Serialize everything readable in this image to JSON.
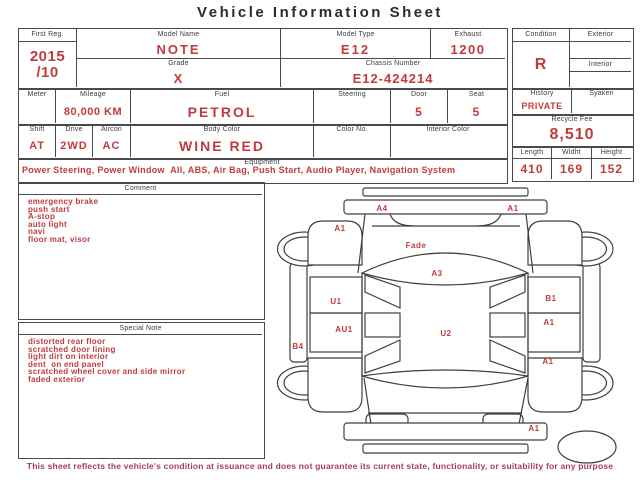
{
  "title": "Vehicle Information Sheet",
  "colors": {
    "accent_red": "#c23b3c",
    "border_gray": "#4a4a4a",
    "label_gray": "#3b3b3b",
    "footer_red": "#a83d52"
  },
  "fields": {
    "first_reg": {
      "label": "First Reg.",
      "value": "2015\n/10"
    },
    "model_name": {
      "label": "Model Name",
      "value": "NOTE"
    },
    "model_type": {
      "label": "Model Type",
      "value": "E12"
    },
    "exhaust": {
      "label": "Exhaust",
      "value": "1200"
    },
    "grade": {
      "label": "Grade",
      "value": "X"
    },
    "chassis_number": {
      "label": "Chassis Number",
      "value": "E12-424214"
    },
    "condition": {
      "label": "Condition",
      "value": "R"
    },
    "exterior": {
      "label": "Exterior",
      "value": ""
    },
    "interior": {
      "label": "Interior",
      "value": ""
    },
    "meter": {
      "label": "Meter",
      "value": ""
    },
    "mileage": {
      "label": "Mileage",
      "value": "80,000 KM"
    },
    "fuel": {
      "label": "Fuel",
      "value": "PETROL"
    },
    "steering": {
      "label": "Steering",
      "value": ""
    },
    "door": {
      "label": "Door",
      "value": "5"
    },
    "seat": {
      "label": "Seat",
      "value": "5"
    },
    "history": {
      "label": "History",
      "value": "PRIVATE"
    },
    "syaken": {
      "label": "Syaken",
      "value": ""
    },
    "shift": {
      "label": "Shift",
      "value": "AT"
    },
    "drive": {
      "label": "Drive",
      "value": "2WD"
    },
    "aircon": {
      "label": "Aircon",
      "value": "AC"
    },
    "body_color": {
      "label": "Body Color",
      "value": "WINE RED"
    },
    "color_no": {
      "label": "Color No.",
      "value": ""
    },
    "interior_color": {
      "label": "Interior Color",
      "value": ""
    },
    "recycle_fee": {
      "label": "Recycle Fee",
      "value": "8,510"
    },
    "equipment": {
      "label": "Equipment",
      "value": "Power Steering, Power Window  All, ABS, Air Bag, Push Start, Audio Player, Navigation System"
    },
    "length": {
      "label": "Length",
      "value": "410"
    },
    "width": {
      "label": "Widht",
      "value": "169"
    },
    "height": {
      "label": "Height",
      "value": "152"
    }
  },
  "comment": {
    "label": "Comment",
    "text": "emergency brake\npush start\nA-stop\nauto light\nnavi\nfloor mat, visor"
  },
  "special_note": {
    "label": "Special Note",
    "text": "distorted rear floor\nscratched door lining\nlight dirt on interior\ndent  on end panel\nscratched wheel cover and side mirror\nfaded exterior"
  },
  "diagram": {
    "labels": [
      "A4",
      "A1",
      "A1",
      "Fade",
      "A3",
      "U1",
      "B1",
      "AU1",
      "A1",
      "U2",
      "B4",
      "A1",
      "A1"
    ]
  },
  "footer": "This sheet reflects the vehicle's condition at issuance and does not guarantee its current state, functionality, or suitability for any purpose"
}
